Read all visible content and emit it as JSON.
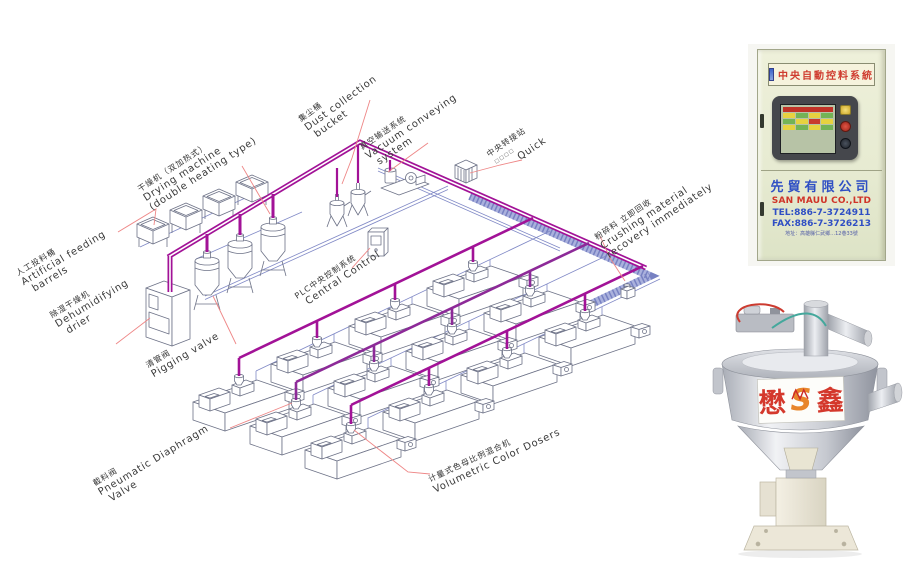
{
  "palette": {
    "pipe_magenta": "#a21297",
    "pipe_magenta_dark": "#8d2a98",
    "pipe_blue_thin": "#8089c6",
    "band_blue": "#aab1dd",
    "band_blue_dark": "#6f79bd",
    "leader_red": "#ee8686",
    "equipment_line": "#6d7287",
    "label_text": "#333333"
  },
  "diagram": {
    "labels": {
      "artificial": {
        "zh": "人工投料桶",
        "en1": "Artificial feeding",
        "en2": "barrels"
      },
      "drying": {
        "zh": "干燥机（双加热式）",
        "en1": "Drying machine",
        "en2": "(double heating type)"
      },
      "dust": {
        "zh": "集尘桶",
        "en1": "Dust collection",
        "en2": "bucket"
      },
      "vacuum": {
        "zh": "真空输送系统",
        "en1": "Vacuum conveying",
        "en2": "system"
      },
      "transfer": {
        "zh": "中央转接站",
        "squares": "□□□□",
        "en1": "Quick"
      },
      "dehumidifying": {
        "zh": "除湿干燥机",
        "en1": "Dehumidifying",
        "en2": "drier"
      },
      "pigging": {
        "zh": "清管阀",
        "en1": "Pigging valve"
      },
      "plc": {
        "zh": "PLC中央控制系统",
        "en1": "Central Control"
      },
      "pneumatic": {
        "zh": "截料阀",
        "en1": "Pneumatic Diaphragm",
        "en2": "Valve"
      },
      "volumetric": {
        "zh": "计量式色母比例混合机",
        "en1": "Volumetric Color Dosers"
      },
      "crushing": {
        "zh": "粉碎料 立即回收",
        "en1": "Crushing material",
        "en2": "recovery immediately"
      }
    }
  },
  "cabinet": {
    "sign": "中央自動控料系統",
    "company_zh": "先貿有限公司",
    "company_en": "SAN MAUU CO.,LTD",
    "tel": "TEL:886-7-3724911",
    "fax": "FAX:886-7-3726213",
    "address": "地址：高雄縣仁武鄉…12巷33號"
  },
  "hopper": {
    "label_left": "懋",
    "label_right": "鑫",
    "logo": "S"
  }
}
